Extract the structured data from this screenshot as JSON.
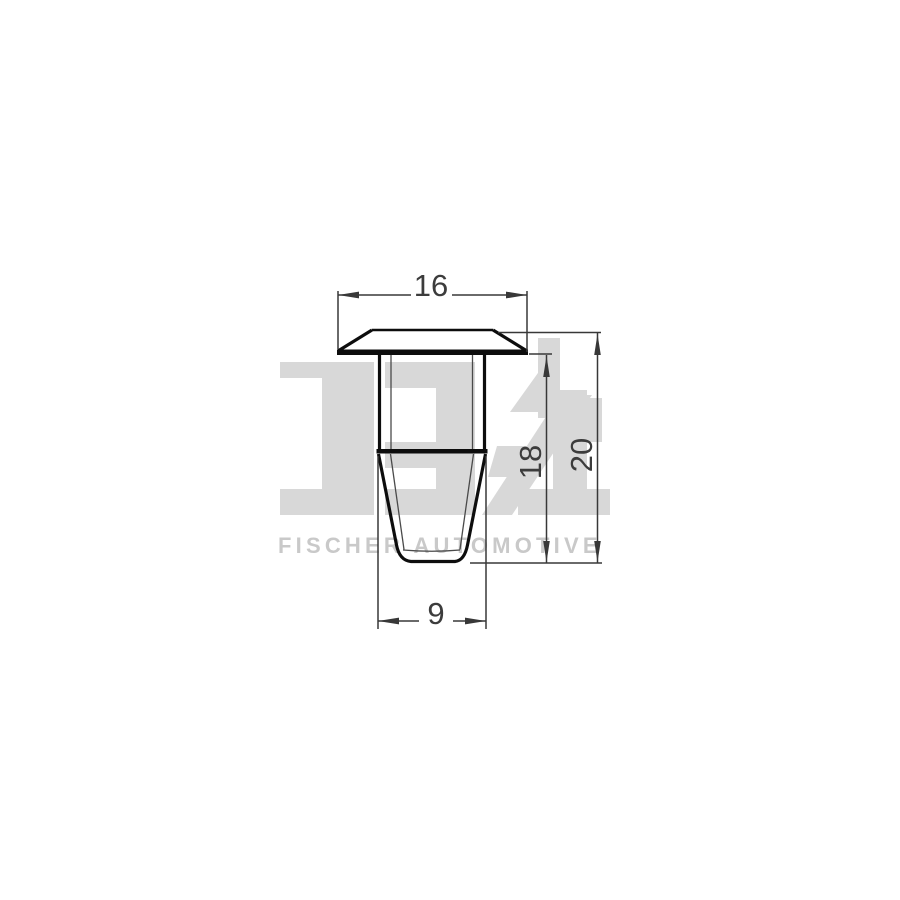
{
  "drawing": {
    "type": "technical-dimension-drawing",
    "view": "side-profile of trim clip with mushroom head, shank and tapered expanding tip",
    "dimensions": {
      "head_width": "16",
      "shank_height": "18",
      "total_height": "20",
      "tip_width": "9"
    }
  },
  "watermark": {
    "logo": "FA1",
    "caption": "FISCHER AUTOMOTIVE"
  },
  "colors": {
    "background": "#ffffff",
    "outline": "#0d0d0d",
    "inner_lines": "#4a4a4a",
    "dimension_lines": "#383838",
    "dimension_text": "#3c3c3c",
    "watermark_shapes": "#d8d8d8",
    "watermark_caption": "#c9c9c9"
  }
}
